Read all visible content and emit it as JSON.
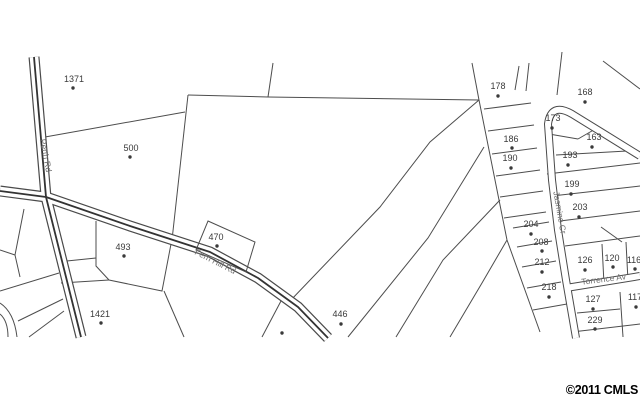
{
  "map": {
    "background": "#ffffff",
    "parcel_line_color": "#4d4d4d",
    "road_edge_color": "#4a4a4a",
    "road_center_color": "#333333",
    "lot_label_color": "#3a3a3a",
    "road_label_color": "#6e6e6e",
    "copyright": "©2011 CMLS",
    "copyright_color": "#000000",
    "roads": [
      {
        "name": "Perth Rd",
        "x": 43,
        "y": 156,
        "angle": 79
      },
      {
        "name": "Fern Hill Rd",
        "x": 214,
        "y": 264,
        "angle": 27
      },
      {
        "name": "Jasmine Cr",
        "x": 557,
        "y": 213,
        "angle": 80
      },
      {
        "name": "Torrence Av",
        "x": 604,
        "y": 282,
        "angle": -7
      }
    ],
    "lots": [
      {
        "id": "1371",
        "lx": 74,
        "ly": 82,
        "dx": 73,
        "dy": 88
      },
      {
        "id": "500",
        "lx": 131,
        "ly": 151,
        "dx": 130,
        "dy": 157
      },
      {
        "id": "493",
        "lx": 123,
        "ly": 250,
        "dx": 124,
        "dy": 256
      },
      {
        "id": "470",
        "lx": 216,
        "ly": 240,
        "dx": 217,
        "dy": 246
      },
      {
        "id": "1421",
        "lx": 100,
        "ly": 317,
        "dx": 101,
        "dy": 323
      },
      {
        "id": "446",
        "lx": 340,
        "ly": 317,
        "dx": 341,
        "dy": 324
      },
      {
        "id": "178",
        "lx": 498,
        "ly": 89,
        "dx": 498,
        "dy": 96
      },
      {
        "id": "168",
        "lx": 585,
        "ly": 95,
        "dx": 585,
        "dy": 102
      },
      {
        "id": "173",
        "lx": 553,
        "ly": 121,
        "dx": 552,
        "dy": 128
      },
      {
        "id": "163",
        "lx": 594,
        "ly": 140,
        "dx": 592,
        "dy": 147
      },
      {
        "id": "186",
        "lx": 511,
        "ly": 142,
        "dx": 512,
        "dy": 148
      },
      {
        "id": "190",
        "lx": 510,
        "ly": 161,
        "dx": 511,
        "dy": 168
      },
      {
        "id": "193",
        "lx": 570,
        "ly": 158,
        "dx": 568,
        "dy": 165
      },
      {
        "id": "199",
        "lx": 572,
        "ly": 187,
        "dx": 571,
        "dy": 194
      },
      {
        "id": "203",
        "lx": 580,
        "ly": 210,
        "dx": 579,
        "dy": 217
      },
      {
        "id": "204",
        "lx": 531,
        "ly": 227,
        "dx": 531,
        "dy": 234
      },
      {
        "id": "208",
        "lx": 541,
        "ly": 245,
        "dx": 542,
        "dy": 251
      },
      {
        "id": "212",
        "lx": 542,
        "ly": 265,
        "dx": 542,
        "dy": 272
      },
      {
        "id": "218",
        "lx": 549,
        "ly": 290,
        "dx": 549,
        "dy": 297
      },
      {
        "id": "126",
        "lx": 585,
        "ly": 263,
        "dx": 585,
        "dy": 270
      },
      {
        "id": "120",
        "lx": 612,
        "ly": 261,
        "dx": 613,
        "dy": 267
      },
      {
        "id": "116",
        "lx": 634,
        "ly": 263,
        "dx": 635,
        "dy": 269
      },
      {
        "id": "127",
        "lx": 593,
        "ly": 302,
        "dx": 593,
        "dy": 309
      },
      {
        "id": "117",
        "lx": 635,
        "ly": 300,
        "dx": 636,
        "dy": 307
      },
      {
        "id": "229",
        "lx": 595,
        "ly": 323,
        "dx": 595,
        "dy": 329
      }
    ],
    "unlabeled_dots": [
      {
        "dx": 282,
        "dy": 333
      }
    ]
  }
}
